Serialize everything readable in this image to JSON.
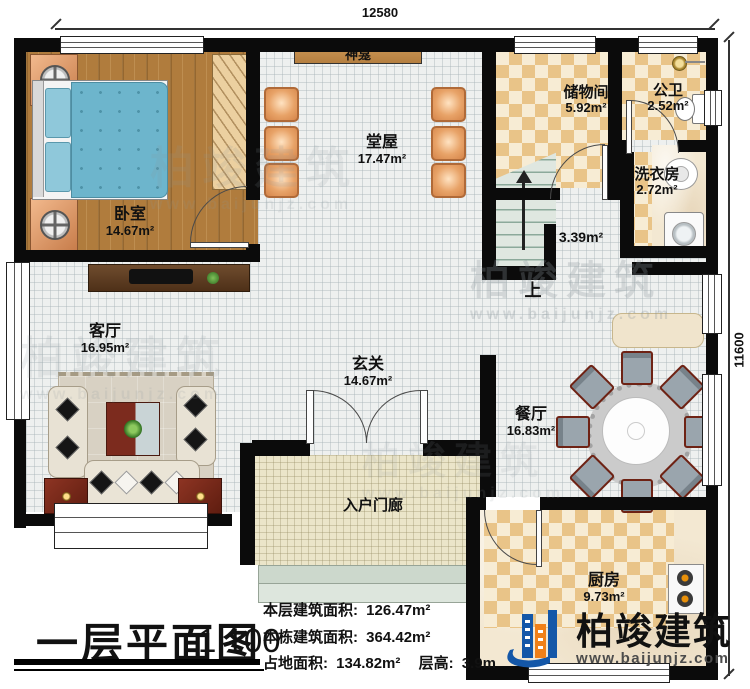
{
  "dimensions": {
    "top": "12580",
    "right": "11600"
  },
  "rooms": {
    "bedroom": {
      "name": "卧室",
      "area": "14.67m²"
    },
    "hall": {
      "name": "堂屋",
      "area": "17.47m²"
    },
    "shrine": {
      "name": "神龛"
    },
    "storage": {
      "name": "储物间",
      "area": "5.92m²"
    },
    "wc": {
      "name": "公卫",
      "area": "2.52m²"
    },
    "laundry": {
      "name": "洗衣房",
      "area": "2.72m²"
    },
    "stairwell": {
      "area": "3.39m²",
      "direction": "上"
    },
    "living": {
      "name": "客厅",
      "area": "16.95m²"
    },
    "foyer": {
      "name": "玄关",
      "area": "14.67m²"
    },
    "dining": {
      "name": "餐厅",
      "area": "16.83m²"
    },
    "kitchen": {
      "name": "厨房",
      "area": "9.73m²"
    },
    "porch": {
      "name": "入户门廊"
    }
  },
  "titleblock": {
    "title": "一层平面图",
    "scale": "1:100",
    "stats": [
      {
        "label": "本层建筑面积:",
        "value": "126.47m²"
      },
      {
        "label": "本栋建筑面积:",
        "value": "364.42m²"
      },
      {
        "label": "占地面积:",
        "value": "134.82m²"
      },
      {
        "label": "层高:",
        "value": "3.9m"
      }
    ]
  },
  "brand": {
    "name": "柏竣建筑",
    "website": "www.baijunjz.com"
  },
  "watermark": {
    "name": "柏竣建筑",
    "website": "www.baijunjz.com"
  }
}
